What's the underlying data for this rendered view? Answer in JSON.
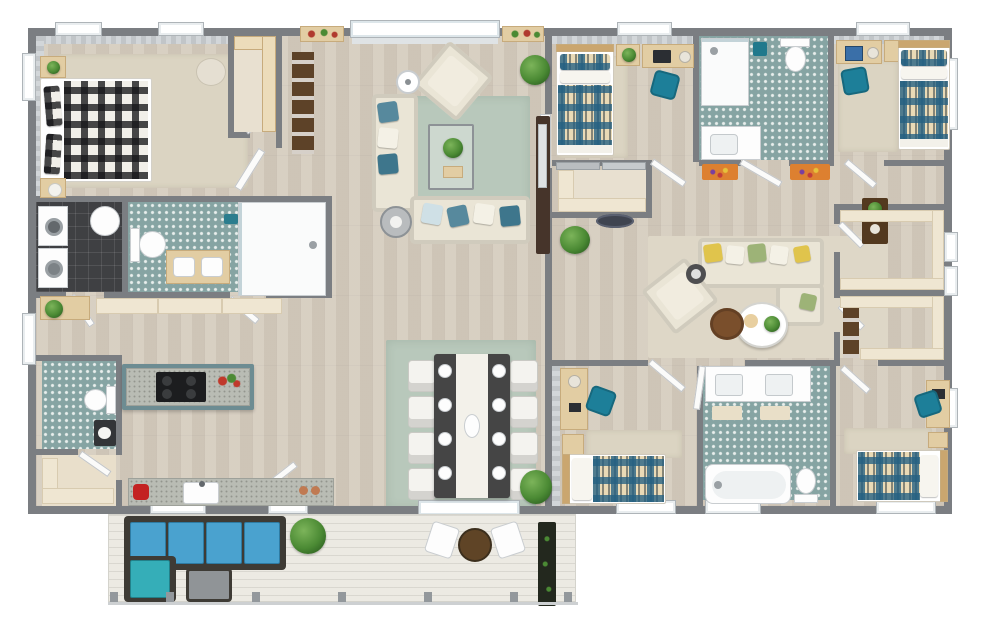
{
  "scene": {
    "type": "3d-floor-plan-top-view",
    "style": "photoreal render, gray walls, light oak floors, white exterior windows",
    "text_labels": "none visible"
  },
  "palette": {
    "wall": "#7b7e82",
    "wood": "#d5ccbe",
    "deck": "#eceae3",
    "tileTeal": "#86a4a3",
    "tileDark": "#3f4043",
    "rugSage": "#b8c8bb",
    "rugCream": "#dbd4c2",
    "sofa": "#eae5d6",
    "cabinet": "#efe6d2",
    "woodFurn": "#e2cda3",
    "chairTeal": "#1d7f99",
    "sectionalBlue": "#4aa2cf",
    "plaidBase": "#e9dab6",
    "brown": "#5d4228",
    "plaidTeal": "#246082",
    "pillowTeal": "#57899d",
    "accentYellow": "#e0c44c",
    "accentGreen": "#9db377",
    "mixerRed": "#c32222"
  },
  "rooms": [
    {
      "name": "Master Bedroom",
      "wing": "left",
      "floor": "wood + cream rug",
      "furniture": [
        "double bed with black-and-white plaid duvet",
        "two plaid pillows",
        "two wood nightstands",
        "round pouf",
        "striped accent walls"
      ]
    },
    {
      "name": "Master Walk-in Closet",
      "wing": "left",
      "floor": "wood",
      "furniture": [
        "L-shaped bench shelving",
        "hinged door"
      ]
    },
    {
      "name": "Laundry Room",
      "wing": "left",
      "floor": "dark charcoal tile",
      "furniture": [
        "washer",
        "dryer",
        "round laundry hamper"
      ]
    },
    {
      "name": "Main Bathroom",
      "wing": "left",
      "floor": "teal patterned tile",
      "furniture": [
        "toilet",
        "wood double-sink vanity",
        "walk-in shower",
        "teal towel"
      ]
    },
    {
      "name": "Living Room",
      "wing": "left",
      "floor": "wood + sage rug",
      "furniture": [
        "L-shaped cream sofa with teal pillows",
        "angled armchair",
        "glass coffee table with plant and tray",
        "floor lamp",
        "round side table",
        "TV console with TV",
        "tall shelf with towels",
        "potted plant",
        "window flower boxes",
        "front sliding glass door"
      ]
    },
    {
      "name": "Kitchen",
      "wing": "left",
      "floor": "wood",
      "furniture": [
        "island with teal base, speckled counter and black cooktop",
        "vegetable basket",
        "perimeter counter with sink",
        "red stand mixer",
        "terracotta jars",
        "cream cabinet with plant",
        "upper cabinet run"
      ]
    },
    {
      "name": "Powder Room",
      "wing": "left",
      "floor": "teal patterned tile",
      "furniture": [
        "toilet",
        "dark-counter vanity with sink"
      ]
    },
    {
      "name": "Pantry Closet",
      "wing": "left",
      "floor": "cream",
      "furniture": [
        "L-shaped shelving",
        "hinged door"
      ]
    },
    {
      "name": "Dining Room",
      "wing": "left",
      "floor": "wood + sage rug",
      "furniture": [
        "dark dining table with white runner",
        "8 white chairs",
        "8 place settings",
        "centerpiece bowl",
        "potted plant"
      ]
    },
    {
      "name": "Deck",
      "wing": "bottom",
      "floor": "white planks",
      "furniture": [
        "blue L-sectional with dark frame",
        "gray ottoman",
        "potted plant",
        "round bistro table",
        "2 white chairs",
        "long planter box",
        "railing posts"
      ]
    },
    {
      "name": "Bedroom 2",
      "wing": "right-top-left",
      "floor": "wood + cream rug",
      "furniture": [
        "twin bed with teal plaid duvet",
        "nightstand with plant",
        "desk with laptop and lamp",
        "teal desk chair"
      ]
    },
    {
      "name": "Bathroom 2",
      "wing": "right-top-middle",
      "floor": "teal patterned tile",
      "furniture": [
        "walk-in shower",
        "toilet",
        "white vanity with sink",
        "teal bin"
      ]
    },
    {
      "name": "Bedroom 3",
      "wing": "right-top-right",
      "floor": "wood + cream rug",
      "furniture": [
        "twin bed with teal plaid duvet",
        "desk with laptop",
        "teal desk chair",
        "nightstand"
      ]
    },
    {
      "name": "Hall Closet",
      "wing": "right",
      "floor": "wood",
      "furniture": [
        "L-shaped cream shelving",
        "gray sliding doors",
        "dark oval rug outside"
      ]
    },
    {
      "name": "Family Room",
      "wing": "right-middle",
      "floor": "wood + cream rug",
      "furniture": [
        "cream sofa with yellow, green and white pillows",
        "chaise corner",
        "angled armchair",
        "round white coffee table with plant and bowl",
        "round brown ottoman",
        "dark side table"
      ]
    },
    {
      "name": "Walk-in Closet A",
      "wing": "right",
      "floor": "wood",
      "furniture": [
        "U-shaped cream shelving"
      ]
    },
    {
      "name": "Walk-in Closet B",
      "wing": "right",
      "floor": "wood",
      "furniture": [
        "U-shaped cream shelving",
        "tall brown bookshelf"
      ]
    },
    {
      "name": "Hallway",
      "wing": "right",
      "floor": "wood",
      "furniture": [
        "two multicolor runner rugs",
        "potted plant",
        "brown console with plants"
      ]
    },
    {
      "name": "Bedroom 4",
      "wing": "right-bottom-left",
      "floor": "wood + cream rug",
      "furniture": [
        "twin bed with teal plaid duvet",
        "wall desk with lamp",
        "teal desk chair",
        "storage shelf"
      ]
    },
    {
      "name": "Bathroom 3",
      "wing": "right-bottom-middle",
      "floor": "teal patterned tile",
      "furniture": [
        "double-sink vanity",
        "two cream bath mats",
        "bathtub",
        "toilet"
      ]
    },
    {
      "name": "Bedroom 5",
      "wing": "right-bottom-right",
      "floor": "wood + cream rug",
      "furniture": [
        "twin bed with teal plaid duvet",
        "desk",
        "teal desk chair",
        "nightstand"
      ]
    }
  ],
  "counts": {
    "bedrooms": 5,
    "bathrooms": 4,
    "dining_chairs": 8,
    "deck_bistro_chairs": 2,
    "walk_in_closets": 4
  }
}
